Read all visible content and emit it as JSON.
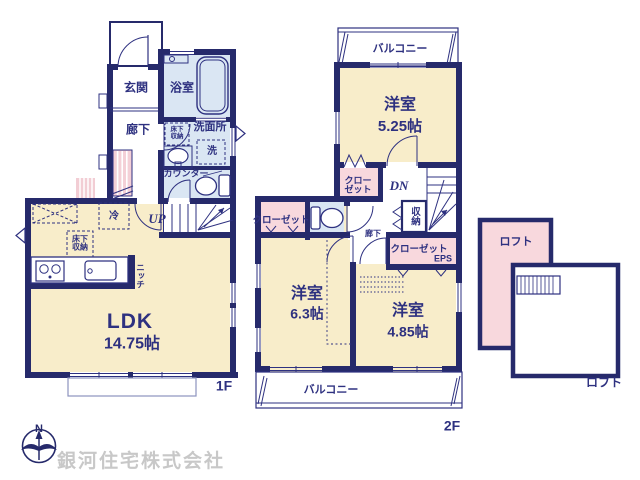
{
  "colors": {
    "wall": "#262a6b",
    "line": "#2e3180",
    "room_tan": "#f8edca",
    "room_blue": "#dae6f3",
    "closet_pink": "#f8d8dd",
    "stairs_pink": "#f4d0d7",
    "logo_gray": "#c8c8c8"
  },
  "f1": {
    "floor_label": "1F",
    "entrance": "玄関",
    "bath": "浴室",
    "hall": "廊下",
    "washroom": "洗面所",
    "washer": "洗",
    "underfloor_storage_wash": "床下収納",
    "counter": "カウンター",
    "fridge": "冷",
    "up": "UP",
    "underfloor_storage_ldk": "床下収納",
    "niche": "ニッチ",
    "ldk_name": "LDK",
    "ldk_size": "14.75帖"
  },
  "f2": {
    "floor_label": "2F",
    "balcony_top": "バルコニー",
    "room_525_name": "洋室",
    "room_525_size": "5.25帖",
    "closet_top": "クローゼット",
    "dn": "DN",
    "closet_left": "クローゼット",
    "hall": "廊下",
    "storage": "収納",
    "closet_right": "クローゼット",
    "eps": "EPS",
    "room_63_name": "洋室",
    "room_63_size": "6.3帖",
    "room_485_name": "洋室",
    "room_485_size": "4.85帖",
    "balcony_bottom": "バルコニー"
  },
  "loft": {
    "label_inner": "ロフト",
    "label_outer": "ロフト"
  },
  "logo": {
    "company": "銀河住宅株式会社",
    "north": "N"
  }
}
